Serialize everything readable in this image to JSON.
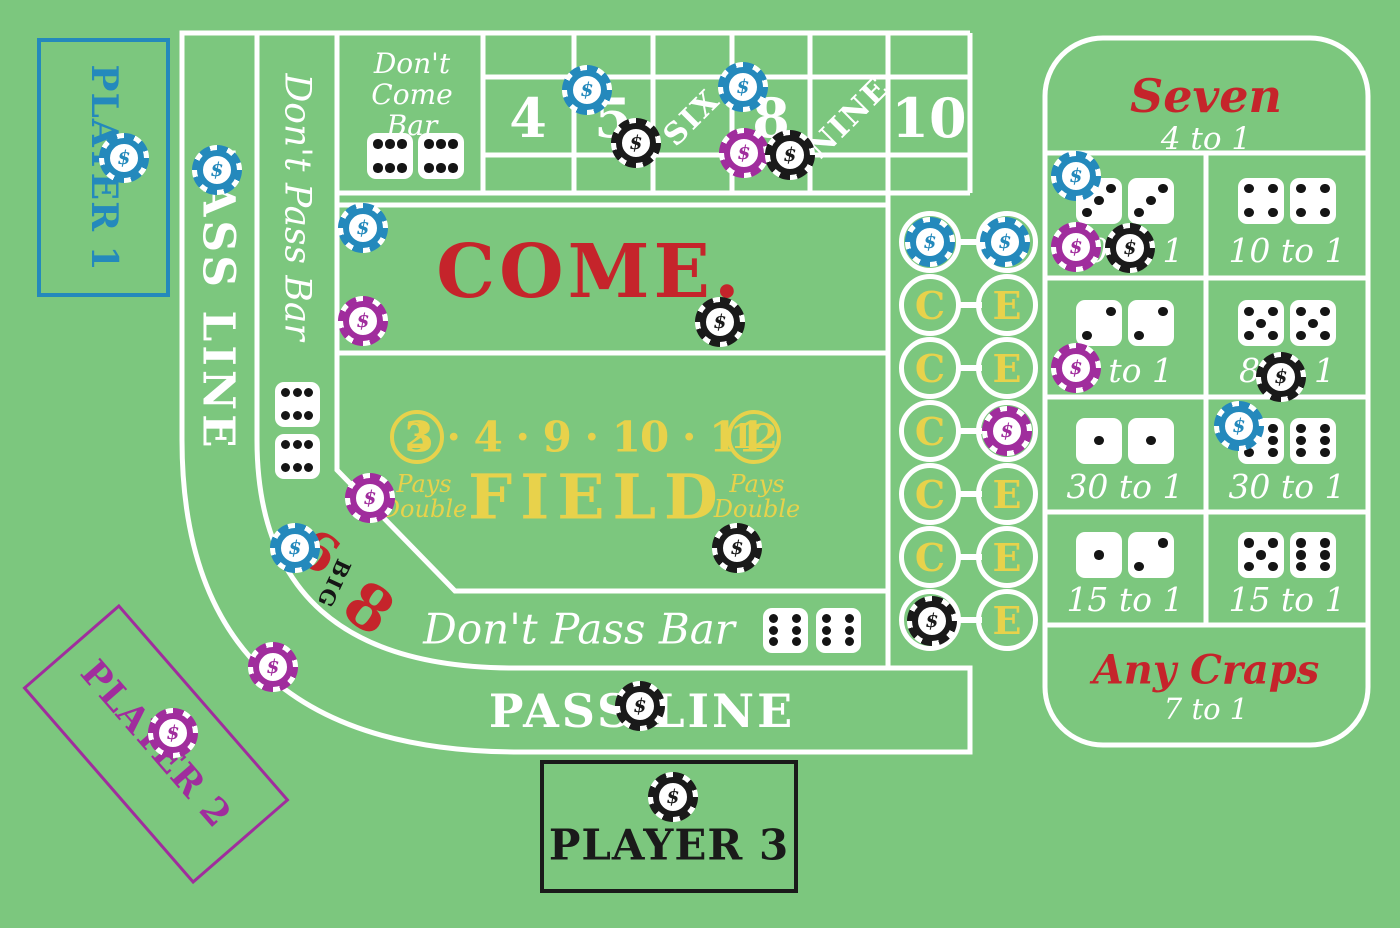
{
  "table": {
    "background": "#7cc77e",
    "line_color": "#ffffff",
    "colors": {
      "red": "#c5242b",
      "yellow": "#e8d24b",
      "blue": "#2489bc",
      "magenta": "#a02d9d",
      "black": "#1a1a1a",
      "white": "#ffffff"
    }
  },
  "chip_symbol": "$",
  "left_rail": {
    "pass_line_label": "PASS LINE",
    "dont_pass_label": "Don't Pass Bar"
  },
  "dont_come": {
    "line1": "Don't",
    "line2": "Come",
    "line3": "Bar"
  },
  "point_boxes": [
    {
      "label": "4",
      "cx": 528,
      "rotated": false
    },
    {
      "label": "5",
      "cx": 613,
      "rotated": false
    },
    {
      "label": "SIX",
      "cx": 692,
      "rotated": true
    },
    {
      "label": "8",
      "cx": 771,
      "rotated": false
    },
    {
      "label": "NINE",
      "cx": 849,
      "rotated": true
    },
    {
      "label": "10",
      "cx": 929,
      "rotated": false
    }
  ],
  "come": {
    "label": "COME."
  },
  "field": {
    "title": "FIELD",
    "circle_left": "2",
    "numbers": "3 · 4 · 9 · 10 · 11",
    "circle_right": "12",
    "pays_line1": "Pays",
    "pays_line2": "Double"
  },
  "big68": {
    "six": "6",
    "big": "BIG",
    "eight": "8"
  },
  "dont_pass_bar_bottom": {
    "label": "Don't Pass Bar"
  },
  "pass_line_bottom": {
    "label": "PASS LINE"
  },
  "ce_column": {
    "c_label": "C",
    "e_label": "E",
    "rows": [
      {
        "y": 242
      },
      {
        "y": 305
      },
      {
        "y": 368
      },
      {
        "y": 431
      },
      {
        "y": 494
      },
      {
        "y": 557
      },
      {
        "y": 620
      }
    ]
  },
  "props": {
    "header_title": "Seven",
    "header_odds": "4 to 1",
    "cells": [
      {
        "row": 0,
        "col": 0,
        "dice": [
          "3",
          "3"
        ],
        "odds": "10 to 1"
      },
      {
        "row": 0,
        "col": 1,
        "dice": [
          "4",
          "4"
        ],
        "odds": "10 to 1"
      },
      {
        "row": 1,
        "col": 0,
        "dice": [
          "2",
          "2"
        ],
        "odds": "8 to 1"
      },
      {
        "row": 1,
        "col": 1,
        "dice": [
          "5",
          "5"
        ],
        "odds": "8 to 1"
      },
      {
        "row": 2,
        "col": 0,
        "dice": [
          "1",
          "1"
        ],
        "odds": "30 to 1"
      },
      {
        "row": 2,
        "col": 1,
        "dice": [
          "6",
          "6"
        ],
        "odds": "30 to 1"
      },
      {
        "row": 3,
        "col": 0,
        "dice": [
          "1",
          "2"
        ],
        "odds": "15 to 1"
      },
      {
        "row": 3,
        "col": 1,
        "dice": [
          "5",
          "6"
        ],
        "odds": "15 to 1"
      }
    ],
    "footer_title": "Any Craps",
    "footer_odds": "7 to 1"
  },
  "printed_dice": [
    {
      "area": "dont-come-bar",
      "value": "6h",
      "x": 390,
      "y": 156,
      "size": 46
    },
    {
      "area": "dont-come-bar",
      "value": "6h",
      "x": 441,
      "y": 156,
      "size": 46
    },
    {
      "area": "dont-pass-rail",
      "value": "6h",
      "x": 297,
      "y": 404,
      "size": 45
    },
    {
      "area": "dont-pass-rail",
      "value": "6h",
      "x": 297,
      "y": 456,
      "size": 45
    },
    {
      "area": "dont-pass-bar-bottom",
      "value": "6",
      "x": 785,
      "y": 630,
      "size": 45
    },
    {
      "area": "dont-pass-bar-bottom",
      "value": "6",
      "x": 838,
      "y": 630,
      "size": 45
    }
  ],
  "players": [
    {
      "label": "PLAYER 1",
      "color": "blue"
    },
    {
      "label": "PLAYER 2",
      "color": "magenta"
    },
    {
      "label": "PLAYER 3",
      "color": "black"
    }
  ],
  "chips": [
    {
      "color": "blue",
      "x": 124,
      "y": 158
    },
    {
      "color": "blue",
      "x": 217,
      "y": 170
    },
    {
      "color": "blue",
      "x": 587,
      "y": 90
    },
    {
      "color": "blue",
      "x": 743,
      "y": 87
    },
    {
      "color": "blue",
      "x": 363,
      "y": 228
    },
    {
      "color": "blue",
      "x": 930,
      "y": 242
    },
    {
      "color": "blue",
      "x": 1005,
      "y": 242
    },
    {
      "color": "blue",
      "x": 1076,
      "y": 176
    },
    {
      "color": "blue",
      "x": 295,
      "y": 548
    },
    {
      "color": "blue",
      "x": 1239,
      "y": 426
    },
    {
      "color": "magenta",
      "x": 363,
      "y": 321
    },
    {
      "color": "magenta",
      "x": 370,
      "y": 498
    },
    {
      "color": "magenta",
      "x": 744,
      "y": 153
    },
    {
      "color": "magenta",
      "x": 1007,
      "y": 431
    },
    {
      "color": "magenta",
      "x": 1076,
      "y": 247
    },
    {
      "color": "magenta",
      "x": 1076,
      "y": 368
    },
    {
      "color": "magenta",
      "x": 273,
      "y": 667
    },
    {
      "color": "magenta",
      "x": 173,
      "y": 733
    },
    {
      "color": "black",
      "x": 636,
      "y": 143
    },
    {
      "color": "black",
      "x": 790,
      "y": 155
    },
    {
      "color": "black",
      "x": 720,
      "y": 322
    },
    {
      "color": "black",
      "x": 737,
      "y": 548
    },
    {
      "color": "black",
      "x": 932,
      "y": 621
    },
    {
      "color": "black",
      "x": 1130,
      "y": 248
    },
    {
      "color": "black",
      "x": 1281,
      "y": 377
    },
    {
      "color": "black",
      "x": 640,
      "y": 706
    },
    {
      "color": "black",
      "x": 673,
      "y": 797
    }
  ]
}
